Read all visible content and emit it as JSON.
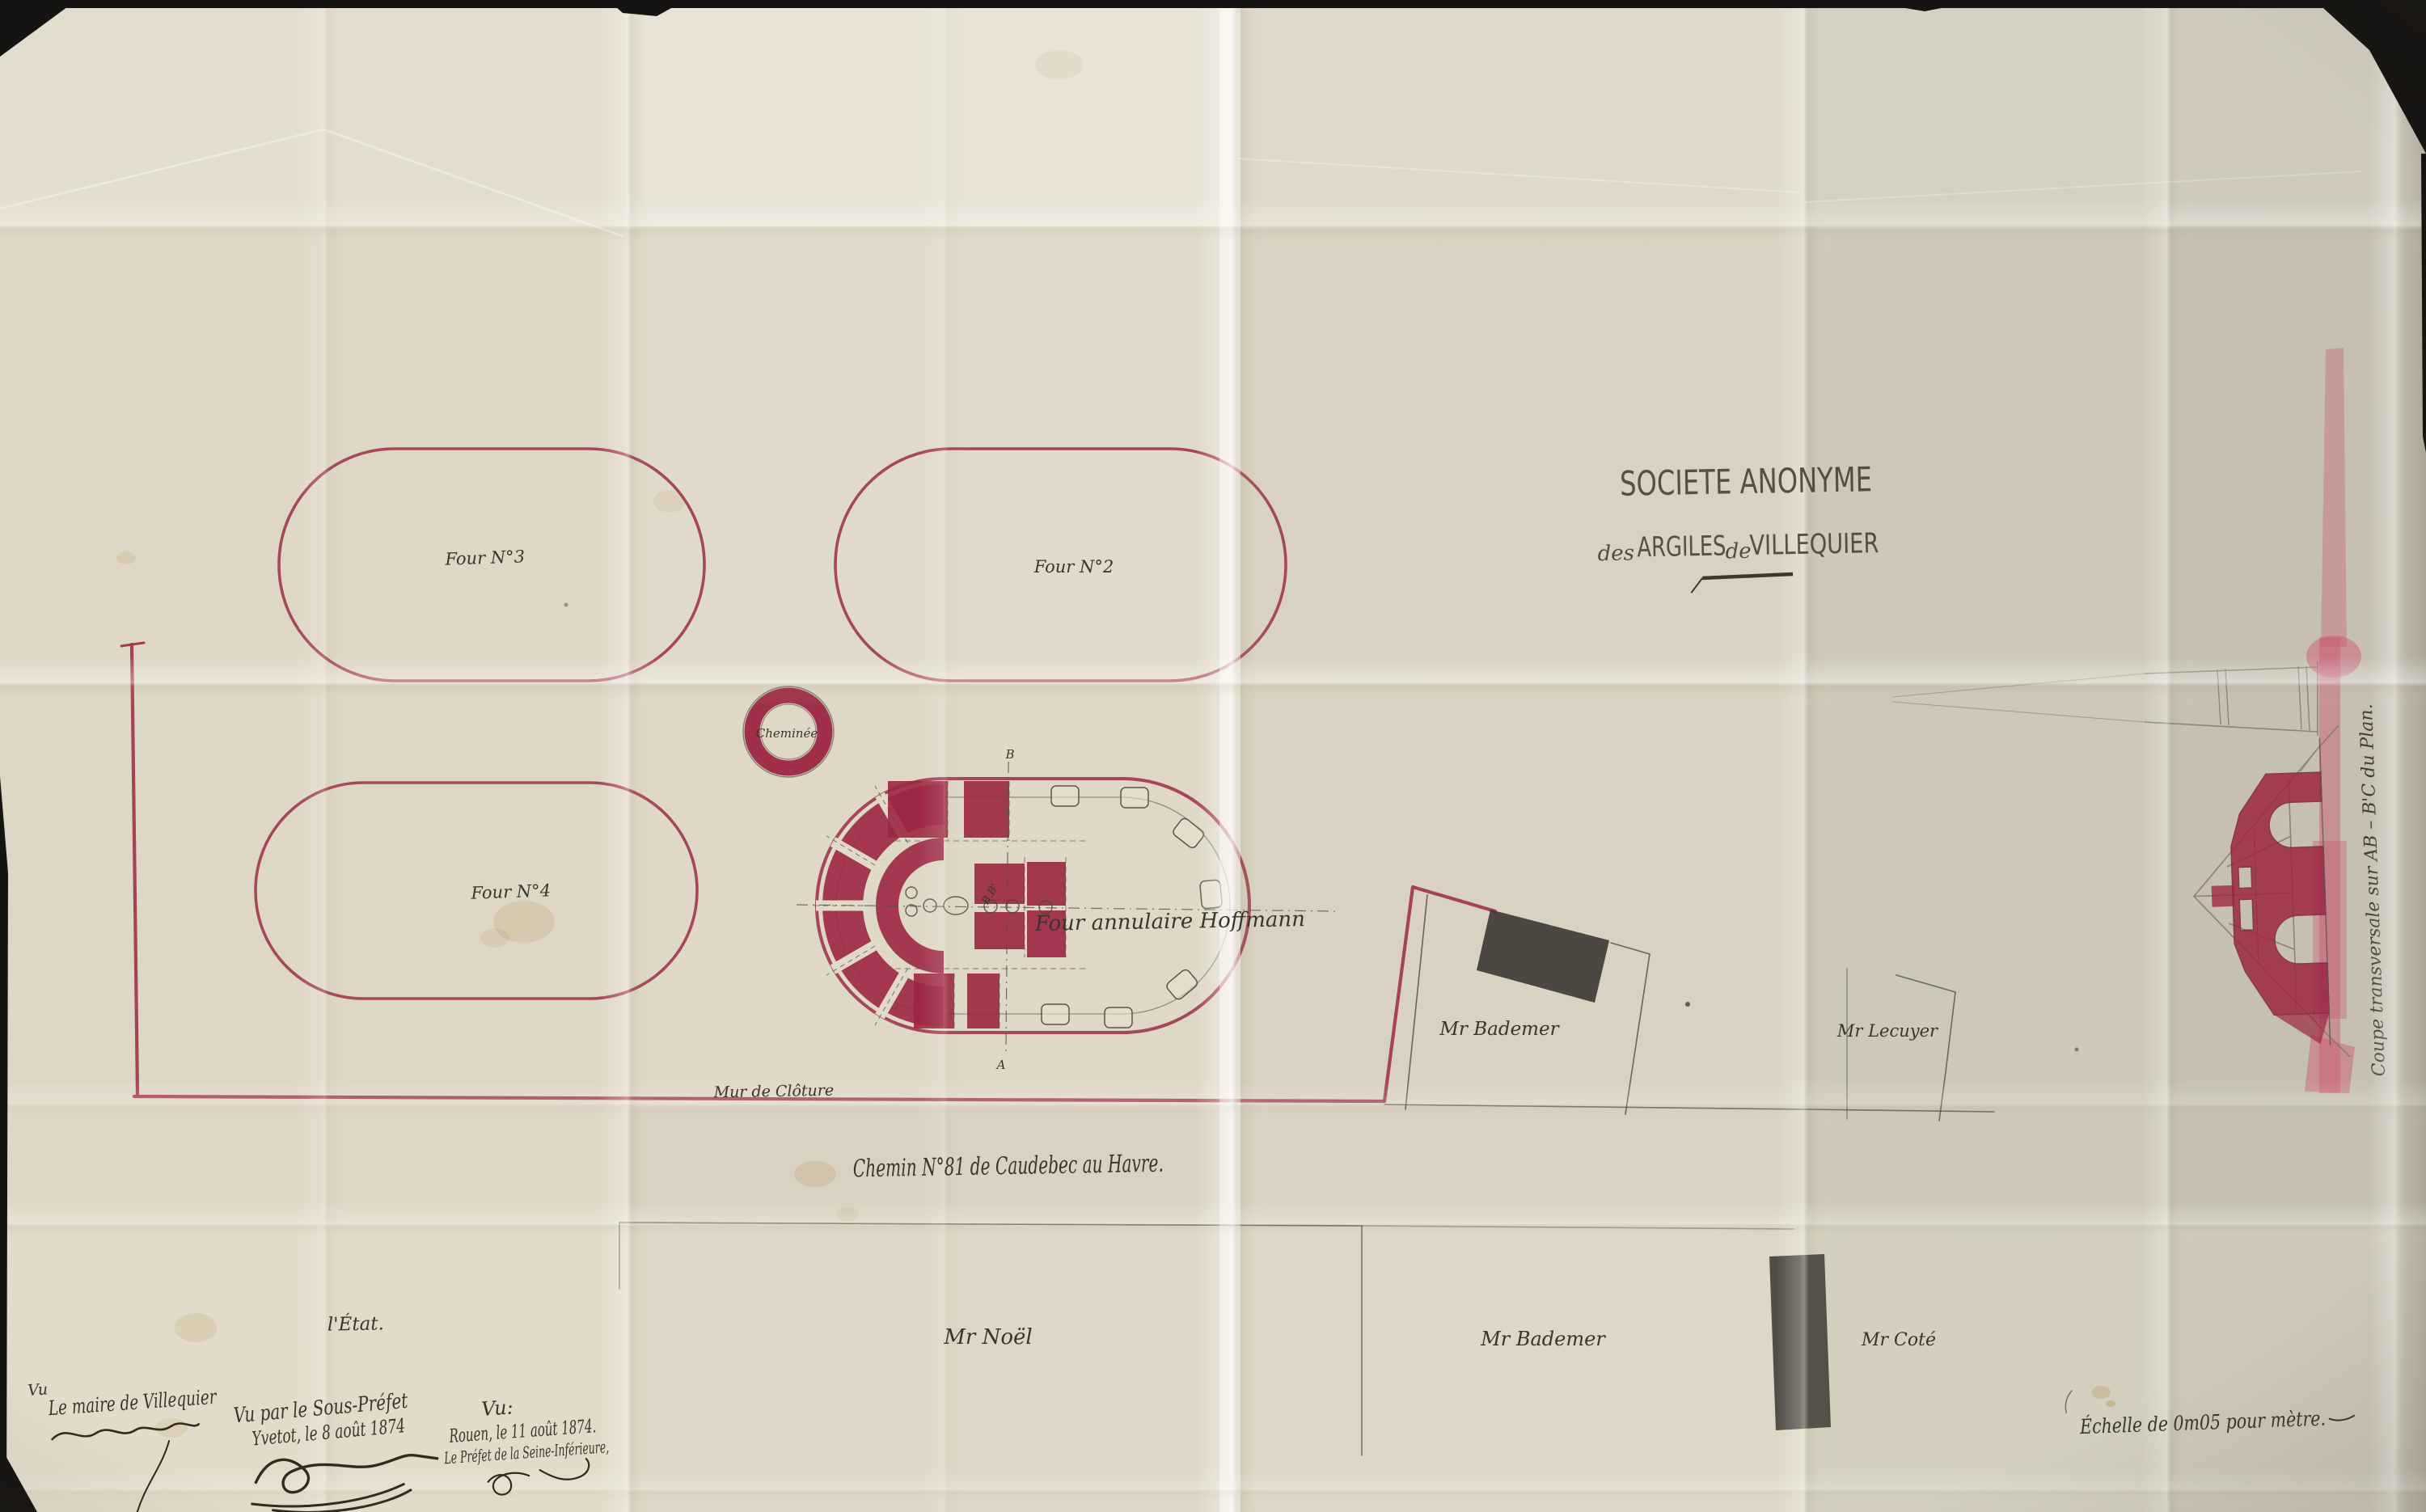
{
  "document_type": "plan ancien photographié",
  "colors": {
    "paper": "#d9d2c2",
    "ink_red_fill": "#9c2742",
    "ink_red_line": "#a23a50",
    "ink_black": "#38332b",
    "ink_sepia": "#32291f",
    "pencil": "#6e675c",
    "building_dark": "#44403a",
    "pink_wash": "#c95c73"
  },
  "title": {
    "line1": "SOCIETE ANONYME",
    "word_des": "des",
    "word_argiles": "ARGILES",
    "word_de": "de",
    "word_villequier": "VILLEQUIER"
  },
  "labels": {
    "four3": "Four N°3",
    "four2": "Four N°2",
    "four4": "Four N°4",
    "cheminee": "Cheminée",
    "hoffmann": "Four annulaire Hoffmann",
    "wall": "Mur de Clôture",
    "road": "Chemin N°81  de  Caudebec  au  Havre.",
    "section_b_top": "B",
    "section_a_bottom": "A",
    "section_bb": "B.B'"
  },
  "parcels": {
    "etat": "l'État.",
    "noel": "Mr Noël",
    "bademer_road": "Mr Bademer",
    "cote": "Mr Coté",
    "bademer_yard": "Mr Bademer",
    "lecuyer": "Mr Lecuyer"
  },
  "section_caption": "Coupe transversale sur AB – B'C du Plan.",
  "scale_note": "Échelle de 0m05 pour mètre.",
  "approvals": {
    "mayor_vu": "Vu",
    "mayor_line": "Le maire de Villequier",
    "sousprefet_line1": "Vu par le Sous-Préfet",
    "sousprefet_line2": "Yvetot, le 8 août 1874",
    "prefet_vu": "Vu:",
    "prefet_line1": "Rouen, le 11 août 1874.",
    "prefet_line2": "Le Préfet de la Seine-Inférieure,"
  }
}
